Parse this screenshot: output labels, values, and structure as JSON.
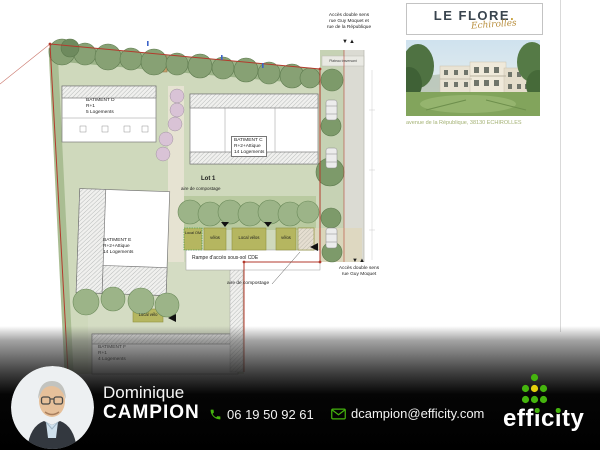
{
  "sidebar": {
    "title": "LE FLORE",
    "title_dot": ".",
    "subtitle": "Echirolles",
    "address": "avenue de la République, 38130 ECHIROLLES"
  },
  "plan": {
    "access_top": [
      "Accès double sens",
      "rue Guy Moquet et",
      "rue de la République"
    ],
    "access_right": [
      "Accès double sens",
      "rue Guy Moquet"
    ],
    "arrows": "▼▲",
    "buildings": {
      "d": [
        "BATIMENT D",
        "R+1",
        "5 Logements"
      ],
      "c": [
        "BATIMENT C",
        "R+2+Attique",
        "14 Logements"
      ],
      "e": [
        "BATIMENT E",
        "R+2+Attique",
        "14 Logements"
      ],
      "f": [
        "BATIMENT F",
        "R+1",
        "4 Logements"
      ]
    },
    "lot": "Lot 1",
    "aire_compostage": "aire de compostage",
    "rampe": "Rampe d'accès sous-sol CDE",
    "local_om": "Local OM",
    "velos": "vélos",
    "local_velos": "Local vélos",
    "local_velo": "Local vélo",
    "plateau": "Plateau traversant"
  },
  "footer": {
    "first_name": "Dominique",
    "last_name": "CAMPION",
    "phone": "06 19 50 92 61",
    "email": "dcampion@efficity.com",
    "logo_parts": {
      "p1": "eff",
      "i1": "i",
      "p2": "c",
      "i2": "i",
      "p3": "ty"
    }
  },
  "colors": {
    "efficity_green": "#45b40e",
    "efficity_yellow": "#e3cf0c",
    "gold": "#bd9a4e",
    "boundary_red": "#b33a2c"
  }
}
